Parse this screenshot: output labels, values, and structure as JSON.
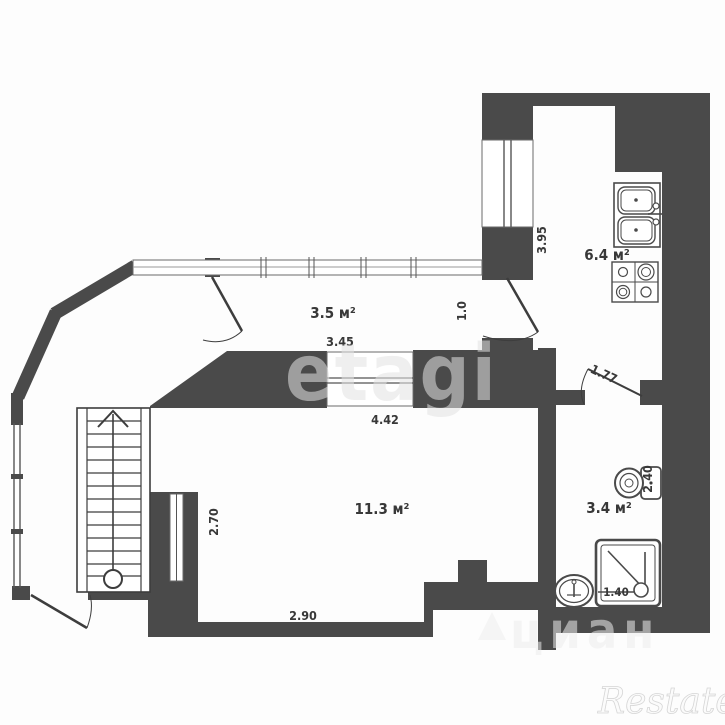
{
  "plan": {
    "type": "apartment floor plan",
    "rooms": {
      "hallway": {
        "area": "3.5 м²"
      },
      "kitchen": {
        "area": "6.4 м²"
      },
      "living": {
        "area": "11.3 м²"
      },
      "bathroom": {
        "area": "3.4 м²"
      }
    },
    "dimensions": {
      "hallway_length": "3.45",
      "hallway_width": "1.0",
      "kitchen_length": "3.95",
      "living_width": "4.42",
      "living_height": "2.70",
      "living_bottom": "2.90",
      "bathroom_door": "1.77",
      "bathroom_height": "2.40",
      "shower_width": "1.40"
    },
    "fixtures": [
      "staircase",
      "kitchen-sink",
      "stove",
      "toilet",
      "shower",
      "washbasin"
    ],
    "colors": {
      "wall": "#4a4a4a",
      "line": "#3d3d3d",
      "background": "#ffffff"
    }
  },
  "watermarks": {
    "center": "etagi",
    "bottom": "циан",
    "corner": "Restate"
  }
}
